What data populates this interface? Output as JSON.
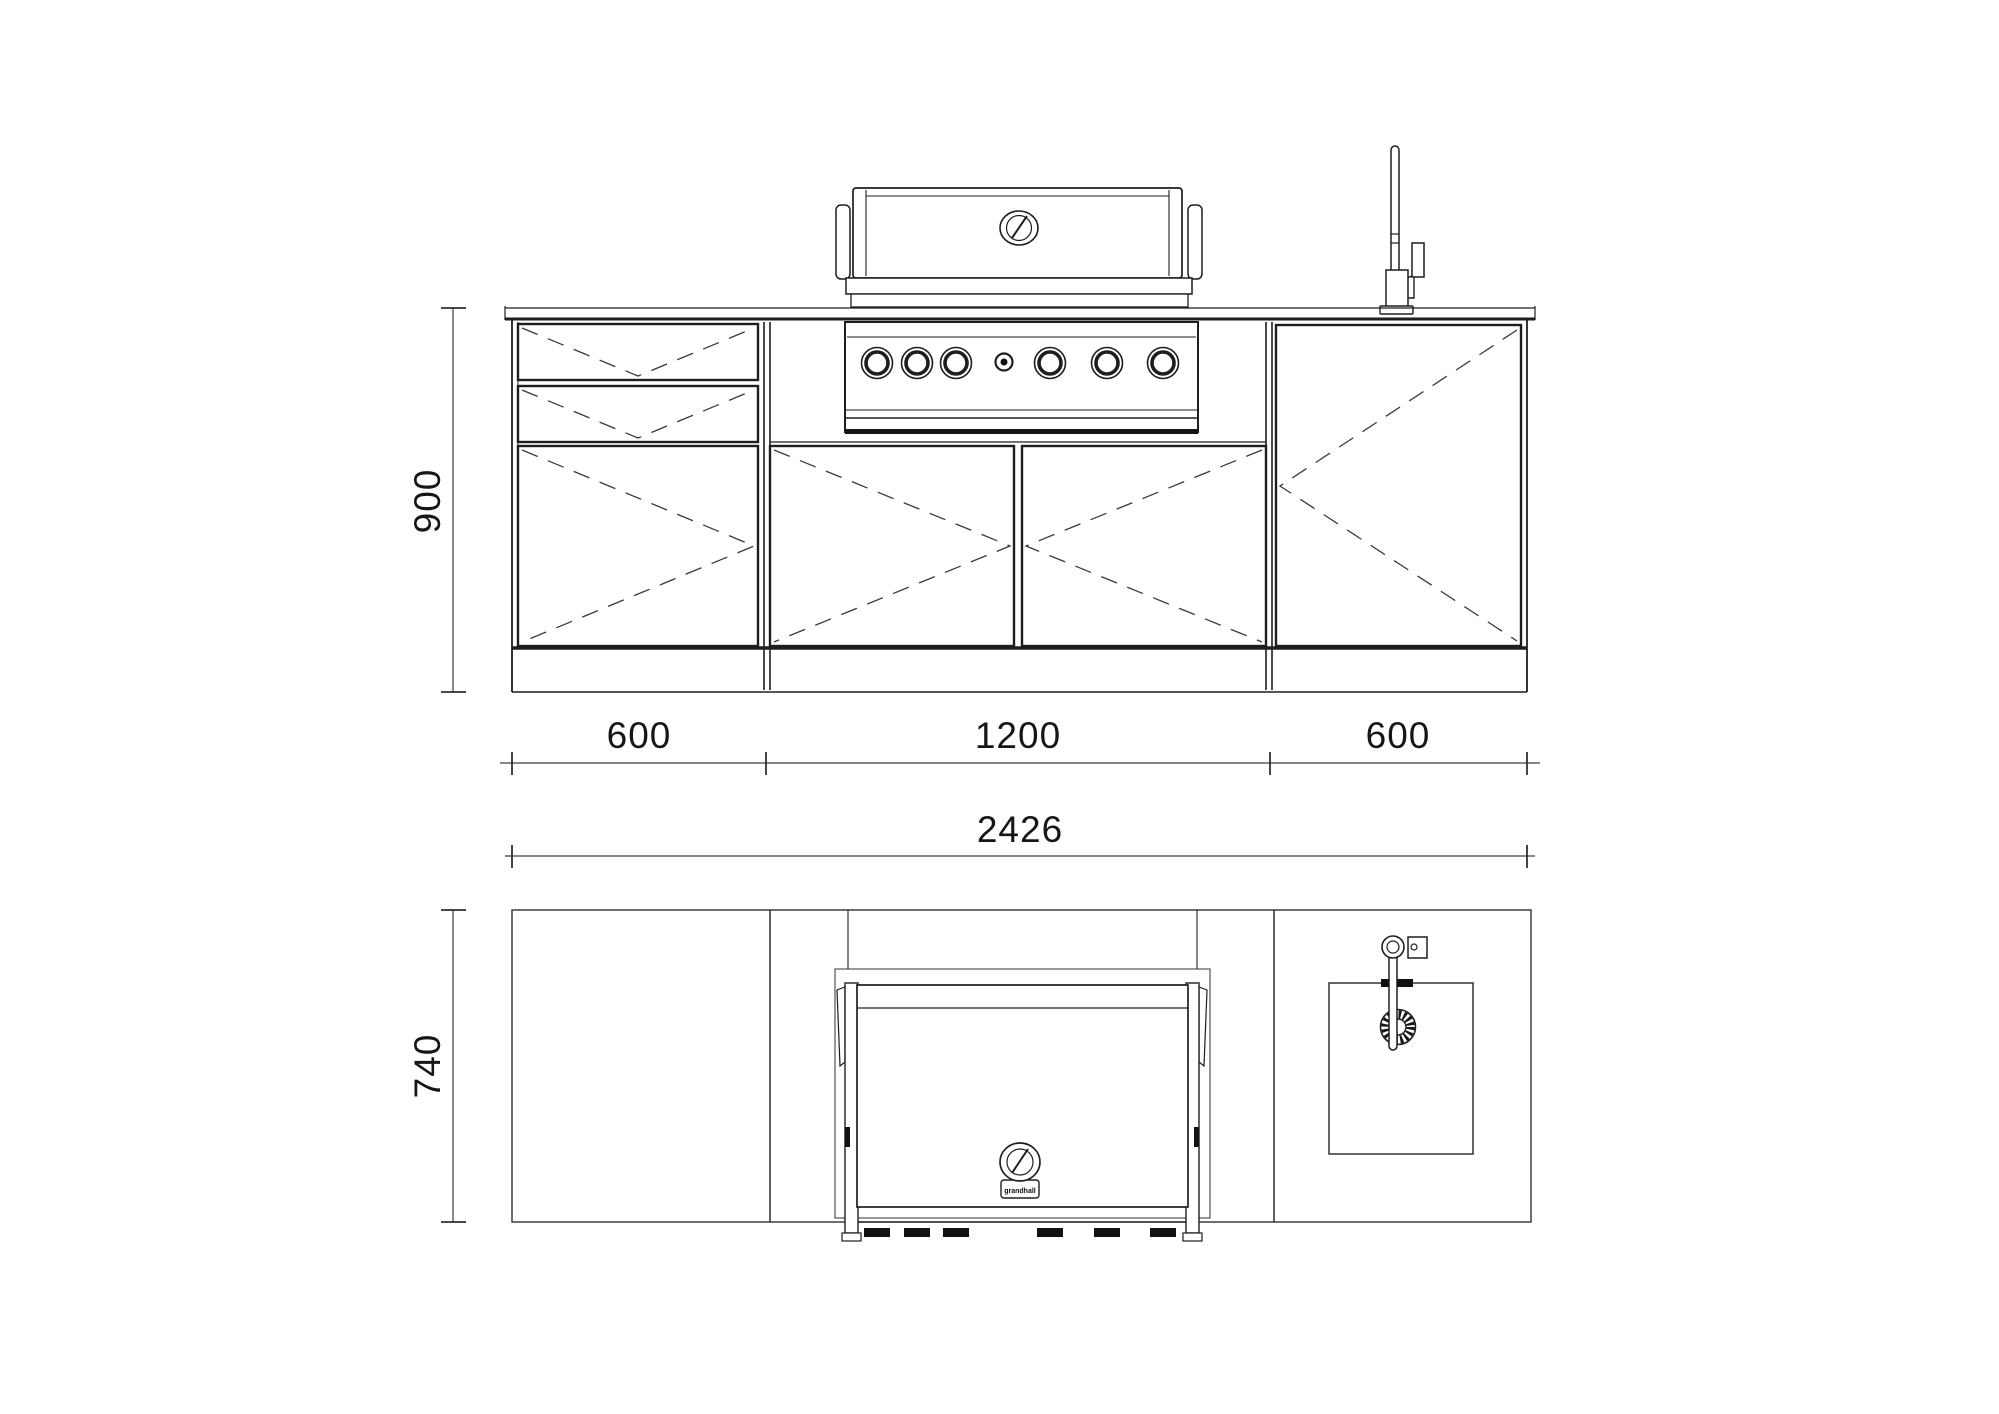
{
  "sheet": {
    "background": "#ffffff",
    "line_color": "#1e1e1e",
    "dash_color": "#3a3a3a"
  },
  "front_view": {
    "height_dim": "900",
    "segment_dims": [
      "600",
      "1200",
      "600"
    ],
    "total_dim": "2426"
  },
  "plan_view": {
    "depth_dim": "740"
  },
  "grill": {
    "brand_label": "grandhall"
  }
}
